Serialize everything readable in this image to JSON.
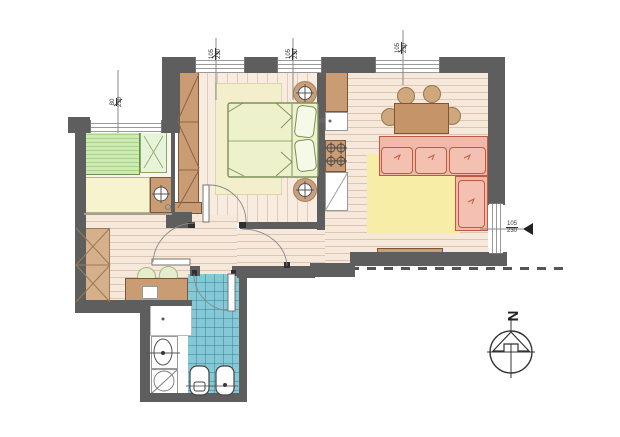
{
  "title": "apartment-floor-plan",
  "dims": {
    "win_small_room": {
      "w": "80",
      "h": "230"
    },
    "win_bedroom_1": {
      "w": "105",
      "h": "230"
    },
    "win_bedroom_2": {
      "w": "105",
      "h": "230"
    },
    "win_living": {
      "w": "105",
      "h": "230"
    },
    "win_right": {
      "w": "105",
      "h": "230"
    }
  },
  "compass": {
    "north_label": "N"
  },
  "colors": {
    "wall": "#5e5e5e",
    "wood_floor": "#f6e8da",
    "wood_line": "#dcc6ae",
    "tile_blue": "#85c9d7",
    "furniture_brown": "#c99c73",
    "sofa_pink": "#f2b9ab",
    "sofa_outline": "#c05a43",
    "rug_yellow": "#f8eda6",
    "rug_beige": "#f3efcd",
    "bed_green": "#cdeab2",
    "bed_cream": "#edf2cd",
    "stool_green": "#e6edca"
  },
  "icons": {
    "lamp": "circle-crosshair",
    "burner": "circle-crosshair",
    "north_arrow": "notched-triangle-in-circle",
    "dimension_arrow": "solid-left-triangle"
  }
}
